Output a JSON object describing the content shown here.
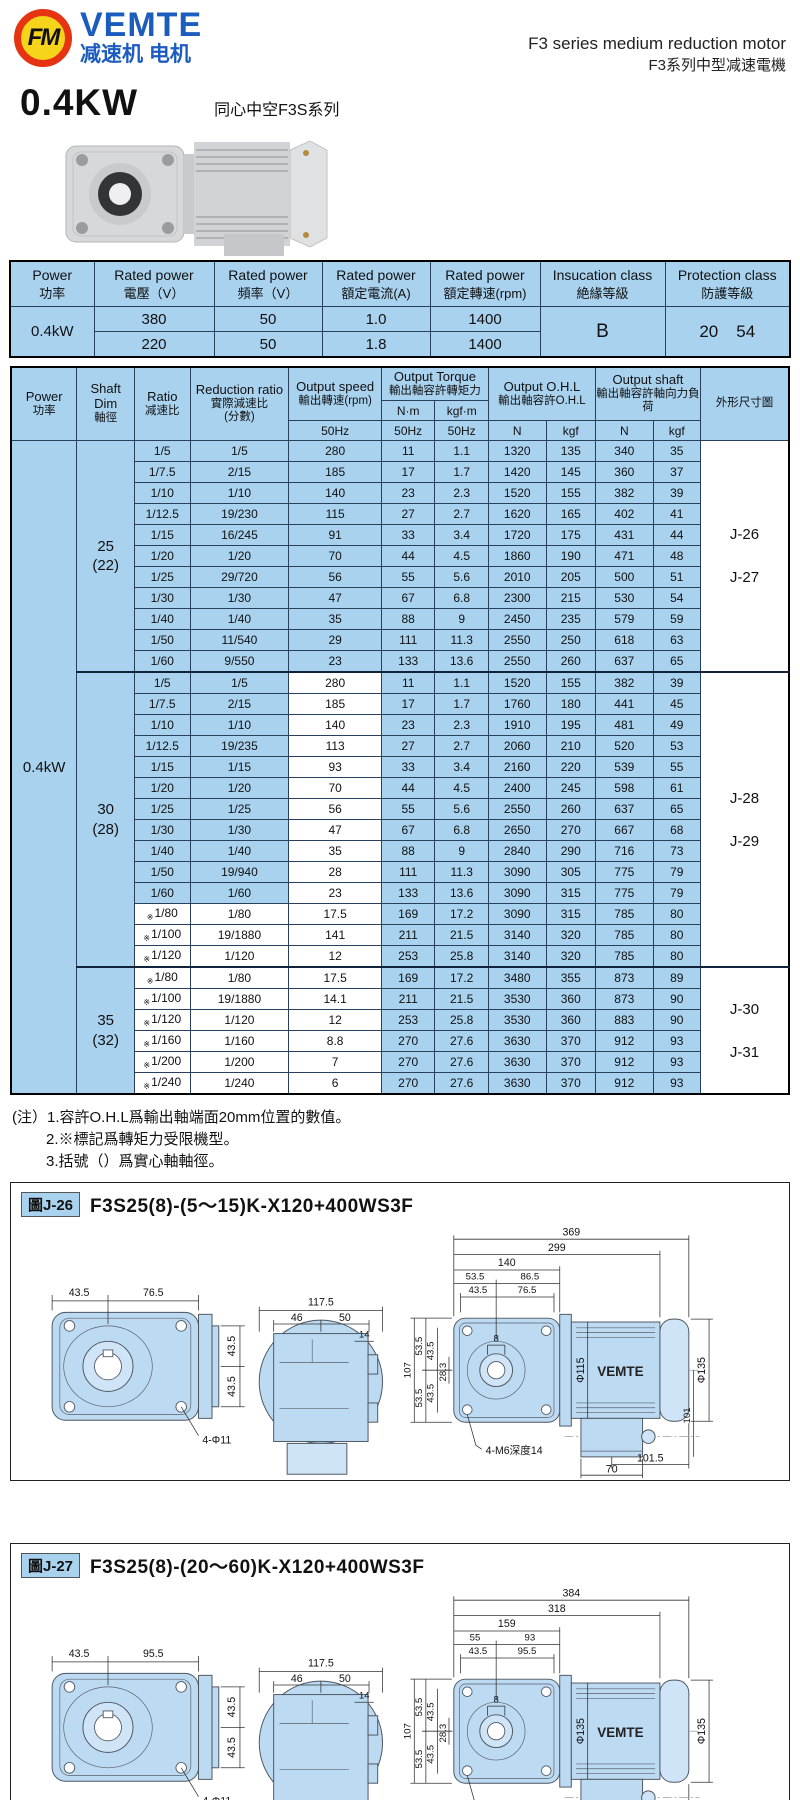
{
  "header": {
    "logo_text": "FM",
    "brand": "VEMTE",
    "brand_sub": "减速机 电机",
    "title_en": "F3 series medium reduction motor",
    "title_zh": "F3系列中型减速電機",
    "power": "0.4KW",
    "series": "同心中空F3S系列"
  },
  "colors": {
    "table_blue": "#a9d2ef",
    "brand_blue": "#1d5cbf",
    "logo_red": "#e63312",
    "logo_yellow": "#f5d41b"
  },
  "spec_table": {
    "headers": [
      {
        "en": "Power",
        "zh": "功率"
      },
      {
        "en": "Rated power",
        "zh": "電壓（V）"
      },
      {
        "en": "Rated power",
        "zh": "頻率（V）"
      },
      {
        "en": "Rated power",
        "zh": "額定電流(A)"
      },
      {
        "en": "Rated power",
        "zh": "額定轉速(rpm)"
      },
      {
        "en": "Insucation class",
        "zh": "絶緣等級"
      },
      {
        "en": "Protection class",
        "zh": "防護等級"
      }
    ],
    "power": "0.4kW",
    "rows": [
      [
        "380",
        "50",
        "1.0",
        "1400"
      ],
      [
        "220",
        "50",
        "1.8",
        "1400"
      ]
    ],
    "insulation": "B",
    "protection": [
      "20",
      "54"
    ]
  },
  "main_table": {
    "power": "0.4kW",
    "star_mark": "※",
    "h": {
      "power_en": "Power",
      "power_zh": "功率",
      "shaft_en": "Shaft Dim",
      "shaft_zh": "軸徑",
      "ratio_en": "Ratio",
      "ratio_zh": "减速比",
      "reduction_en": "Reduction ratio",
      "reduction_zh": "實際減速比",
      "reduction_paren": "(分數)",
      "speed_en": "Output speed",
      "speed_zh": "輸出轉速(rpm)",
      "torque_en": "Output Torque",
      "torque_zh": "輸出軸容許轉矩力",
      "nm": "N·m",
      "kgfm": "kgf·m",
      "ohl_en": "Output O.H.L",
      "ohl_zh": "輸出軸容許O.H.L",
      "shaft_out_en": "Output shaft",
      "shaft_out_zh": "輸出軸容許軸向力負荷",
      "dim": "外形尺寸圖",
      "hz": "50Hz",
      "n": "N",
      "kgf": "kgf"
    },
    "groups": [
      {
        "shaft": "25",
        "shaft_paren": "(22)",
        "dims": [
          "J-26",
          "J-27"
        ],
        "speed_white": false,
        "rows": [
          {
            "ratio": "1/5",
            "star": false,
            "reduction": "1/5",
            "speed": "280",
            "nm": "11",
            "kgfm": "1.1",
            "ohl_n": "1320",
            "ohl_kgf": "135",
            "shaft_n": "340",
            "shaft_kgf": "35"
          },
          {
            "ratio": "1/7.5",
            "star": false,
            "reduction": "2/15",
            "speed": "185",
            "nm": "17",
            "kgfm": "1.7",
            "ohl_n": "1420",
            "ohl_kgf": "145",
            "shaft_n": "360",
            "shaft_kgf": "37"
          },
          {
            "ratio": "1/10",
            "star": false,
            "reduction": "1/10",
            "speed": "140",
            "nm": "23",
            "kgfm": "2.3",
            "ohl_n": "1520",
            "ohl_kgf": "155",
            "shaft_n": "382",
            "shaft_kgf": "39"
          },
          {
            "ratio": "1/12.5",
            "star": false,
            "reduction": "19/230",
            "speed": "115",
            "nm": "27",
            "kgfm": "2.7",
            "ohl_n": "1620",
            "ohl_kgf": "165",
            "shaft_n": "402",
            "shaft_kgf": "41"
          },
          {
            "ratio": "1/15",
            "star": false,
            "reduction": "16/245",
            "speed": "91",
            "nm": "33",
            "kgfm": "3.4",
            "ohl_n": "1720",
            "ohl_kgf": "175",
            "shaft_n": "431",
            "shaft_kgf": "44"
          },
          {
            "ratio": "1/20",
            "star": false,
            "reduction": "1/20",
            "speed": "70",
            "nm": "44",
            "kgfm": "4.5",
            "ohl_n": "1860",
            "ohl_kgf": "190",
            "shaft_n": "471",
            "shaft_kgf": "48"
          },
          {
            "ratio": "1/25",
            "star": false,
            "reduction": "29/720",
            "speed": "56",
            "nm": "55",
            "kgfm": "5.6",
            "ohl_n": "2010",
            "ohl_kgf": "205",
            "shaft_n": "500",
            "shaft_kgf": "51"
          },
          {
            "ratio": "1/30",
            "star": false,
            "reduction": "1/30",
            "speed": "47",
            "nm": "67",
            "kgfm": "6.8",
            "ohl_n": "2300",
            "ohl_kgf": "215",
            "shaft_n": "530",
            "shaft_kgf": "54"
          },
          {
            "ratio": "1/40",
            "star": false,
            "reduction": "1/40",
            "speed": "35",
            "nm": "88",
            "kgfm": "9",
            "ohl_n": "2450",
            "ohl_kgf": "235",
            "shaft_n": "579",
            "shaft_kgf": "59"
          },
          {
            "ratio": "1/50",
            "star": false,
            "reduction": "11/540",
            "speed": "29",
            "nm": "111",
            "kgfm": "11.3",
            "ohl_n": "2550",
            "ohl_kgf": "250",
            "shaft_n": "618",
            "shaft_kgf": "63"
          },
          {
            "ratio": "1/60",
            "star": false,
            "reduction": "9/550",
            "speed": "23",
            "nm": "133",
            "kgfm": "13.6",
            "ohl_n": "2550",
            "ohl_kgf": "260",
            "shaft_n": "637",
            "shaft_kgf": "65"
          }
        ]
      },
      {
        "shaft": "30",
        "shaft_paren": "(28)",
        "dims": [
          "J-28",
          "J-29"
        ],
        "speed_white": true,
        "rows": [
          {
            "ratio": "1/5",
            "star": false,
            "reduction": "1/5",
            "speed": "280",
            "nm": "11",
            "kgfm": "1.1",
            "ohl_n": "1520",
            "ohl_kgf": "155",
            "shaft_n": "382",
            "shaft_kgf": "39"
          },
          {
            "ratio": "1/7.5",
            "star": false,
            "reduction": "2/15",
            "speed": "185",
            "nm": "17",
            "kgfm": "1.7",
            "ohl_n": "1760",
            "ohl_kgf": "180",
            "shaft_n": "441",
            "shaft_kgf": "45"
          },
          {
            "ratio": "1/10",
            "star": false,
            "reduction": "1/10",
            "speed": "140",
            "nm": "23",
            "kgfm": "2.3",
            "ohl_n": "1910",
            "ohl_kgf": "195",
            "shaft_n": "481",
            "shaft_kgf": "49"
          },
          {
            "ratio": "1/12.5",
            "star": false,
            "reduction": "19/235",
            "speed": "113",
            "nm": "27",
            "kgfm": "2.7",
            "ohl_n": "2060",
            "ohl_kgf": "210",
            "shaft_n": "520",
            "shaft_kgf": "53"
          },
          {
            "ratio": "1/15",
            "star": false,
            "reduction": "1/15",
            "speed": "93",
            "nm": "33",
            "kgfm": "3.4",
            "ohl_n": "2160",
            "ohl_kgf": "220",
            "shaft_n": "539",
            "shaft_kgf": "55"
          },
          {
            "ratio": "1/20",
            "star": false,
            "reduction": "1/20",
            "speed": "70",
            "nm": "44",
            "kgfm": "4.5",
            "ohl_n": "2400",
            "ohl_kgf": "245",
            "shaft_n": "598",
            "shaft_kgf": "61"
          },
          {
            "ratio": "1/25",
            "star": false,
            "reduction": "1/25",
            "speed": "56",
            "nm": "55",
            "kgfm": "5.6",
            "ohl_n": "2550",
            "ohl_kgf": "260",
            "shaft_n": "637",
            "shaft_kgf": "65"
          },
          {
            "ratio": "1/30",
            "star": false,
            "reduction": "1/30",
            "speed": "47",
            "nm": "67",
            "kgfm": "6.8",
            "ohl_n": "2650",
            "ohl_kgf": "270",
            "shaft_n": "667",
            "shaft_kgf": "68"
          },
          {
            "ratio": "1/40",
            "star": false,
            "reduction": "1/40",
            "speed": "35",
            "nm": "88",
            "kgfm": "9",
            "ohl_n": "2840",
            "ohl_kgf": "290",
            "shaft_n": "716",
            "shaft_kgf": "73"
          },
          {
            "ratio": "1/50",
            "star": false,
            "reduction": "19/940",
            "speed": "28",
            "nm": "111",
            "kgfm": "11.3",
            "ohl_n": "3090",
            "ohl_kgf": "305",
            "shaft_n": "775",
            "shaft_kgf": "79"
          },
          {
            "ratio": "1/60",
            "star": false,
            "reduction": "1/60",
            "speed": "23",
            "nm": "133",
            "kgfm": "13.6",
            "ohl_n": "3090",
            "ohl_kgf": "315",
            "shaft_n": "775",
            "shaft_kgf": "79"
          },
          {
            "ratio": "1/80",
            "star": true,
            "reduction": "1/80",
            "speed": "17.5",
            "nm": "169",
            "kgfm": "17.2",
            "ohl_n": "3090",
            "ohl_kgf": "315",
            "shaft_n": "785",
            "shaft_kgf": "80"
          },
          {
            "ratio": "1/100",
            "star": true,
            "reduction": "19/1880",
            "speed": "141",
            "nm": "211",
            "kgfm": "21.5",
            "ohl_n": "3140",
            "ohl_kgf": "320",
            "shaft_n": "785",
            "shaft_kgf": "80"
          },
          {
            "ratio": "1/120",
            "star": true,
            "reduction": "1/120",
            "speed": "12",
            "nm": "253",
            "kgfm": "25.8",
            "ohl_n": "3140",
            "ohl_kgf": "320",
            "shaft_n": "785",
            "shaft_kgf": "80"
          }
        ]
      },
      {
        "shaft": "35",
        "shaft_paren": "(32)",
        "dims": [
          "J-30",
          "J-31"
        ],
        "speed_white": true,
        "rows": [
          {
            "ratio": "1/80",
            "star": true,
            "reduction": "1/80",
            "speed": "17.5",
            "nm": "169",
            "kgfm": "17.2",
            "ohl_n": "3480",
            "ohl_kgf": "355",
            "shaft_n": "873",
            "shaft_kgf": "89"
          },
          {
            "ratio": "1/100",
            "star": true,
            "reduction": "19/1880",
            "speed": "14.1",
            "nm": "211",
            "kgfm": "21.5",
            "ohl_n": "3530",
            "ohl_kgf": "360",
            "shaft_n": "873",
            "shaft_kgf": "90"
          },
          {
            "ratio": "1/120",
            "star": true,
            "reduction": "1/120",
            "speed": "12",
            "nm": "253",
            "kgfm": "25.8",
            "ohl_n": "3530",
            "ohl_kgf": "360",
            "shaft_n": "883",
            "shaft_kgf": "90"
          },
          {
            "ratio": "1/160",
            "star": true,
            "reduction": "1/160",
            "speed": "8.8",
            "nm": "270",
            "kgfm": "27.6",
            "ohl_n": "3630",
            "ohl_kgf": "370",
            "shaft_n": "912",
            "shaft_kgf": "93"
          },
          {
            "ratio": "1/200",
            "star": true,
            "reduction": "1/200",
            "speed": "7",
            "nm": "270",
            "kgfm": "27.6",
            "ohl_n": "3630",
            "ohl_kgf": "370",
            "shaft_n": "912",
            "shaft_kgf": "93"
          },
          {
            "ratio": "1/240",
            "star": true,
            "reduction": "1/240",
            "speed": "6",
            "nm": "270",
            "kgfm": "27.6",
            "ohl_n": "3630",
            "ohl_kgf": "370",
            "shaft_n": "912",
            "shaft_kgf": "93"
          }
        ]
      }
    ]
  },
  "notes": {
    "prefix": "(注）",
    "lines": [
      "1.容許O.H.L爲輸出軸端面20mm位置的數值。",
      "2.※標記爲轉矩力受限機型。",
      "3.括號（）爲實心軸軸徑。"
    ]
  },
  "diagrams": [
    {
      "badge": "圖J-26",
      "title": "F3S25(8)-(5～15)K-X120+400WS3F",
      "front": {
        "w1": "43.5",
        "w2": "76.5",
        "h1": "43.5",
        "h2": "43.5",
        "holes": "4-Φ11"
      },
      "face": {
        "total": "117.5",
        "a": "46",
        "b": "50",
        "c": "14"
      },
      "side": {
        "total": "369",
        "len2": "299",
        "len3": "140",
        "l4a": "53.5",
        "l4b": "86.5",
        "l5a": "43.5",
        "l5b": "76.5",
        "v_total": "107",
        "va": "53.5",
        "vb": "53.5",
        "vc": "43.5",
        "vd": "43.5",
        "ve": "28.3",
        "bore": "8",
        "motor_dia": "Φ115",
        "brand": "VEMTE",
        "end_dia": "Φ135",
        "v_right": "101",
        "bot1": "101.5",
        "bot2": "70",
        "tap": "4-M6深度14"
      }
    },
    {
      "badge": "圖J-27",
      "title": "F3S25(8)-(20～60)K-X120+400WS3F",
      "front": {
        "w1": "43.5",
        "w2": "95.5",
        "h1": "43.5",
        "h2": "43.5",
        "holes": "4-Φ11"
      },
      "face": {
        "total": "117.5",
        "a": "46",
        "b": "50",
        "c": "14"
      },
      "side": {
        "total": "384",
        "len2": "318",
        "len3": "159",
        "l4a": "55",
        "l4b": "93",
        "l5a": "43.5",
        "l5b": "95.5",
        "v_total": "107",
        "va": "53.5",
        "vb": "53.5",
        "vc": "43.5",
        "vd": "43.5",
        "ve": "28.3",
        "bore": "8",
        "motor_dia": "Φ135",
        "brand": "VEMTE",
        "end_dia": "Φ135",
        "bot1": "101.5",
        "bot2": "70",
        "tap": "4-M6深度14"
      }
    }
  ]
}
